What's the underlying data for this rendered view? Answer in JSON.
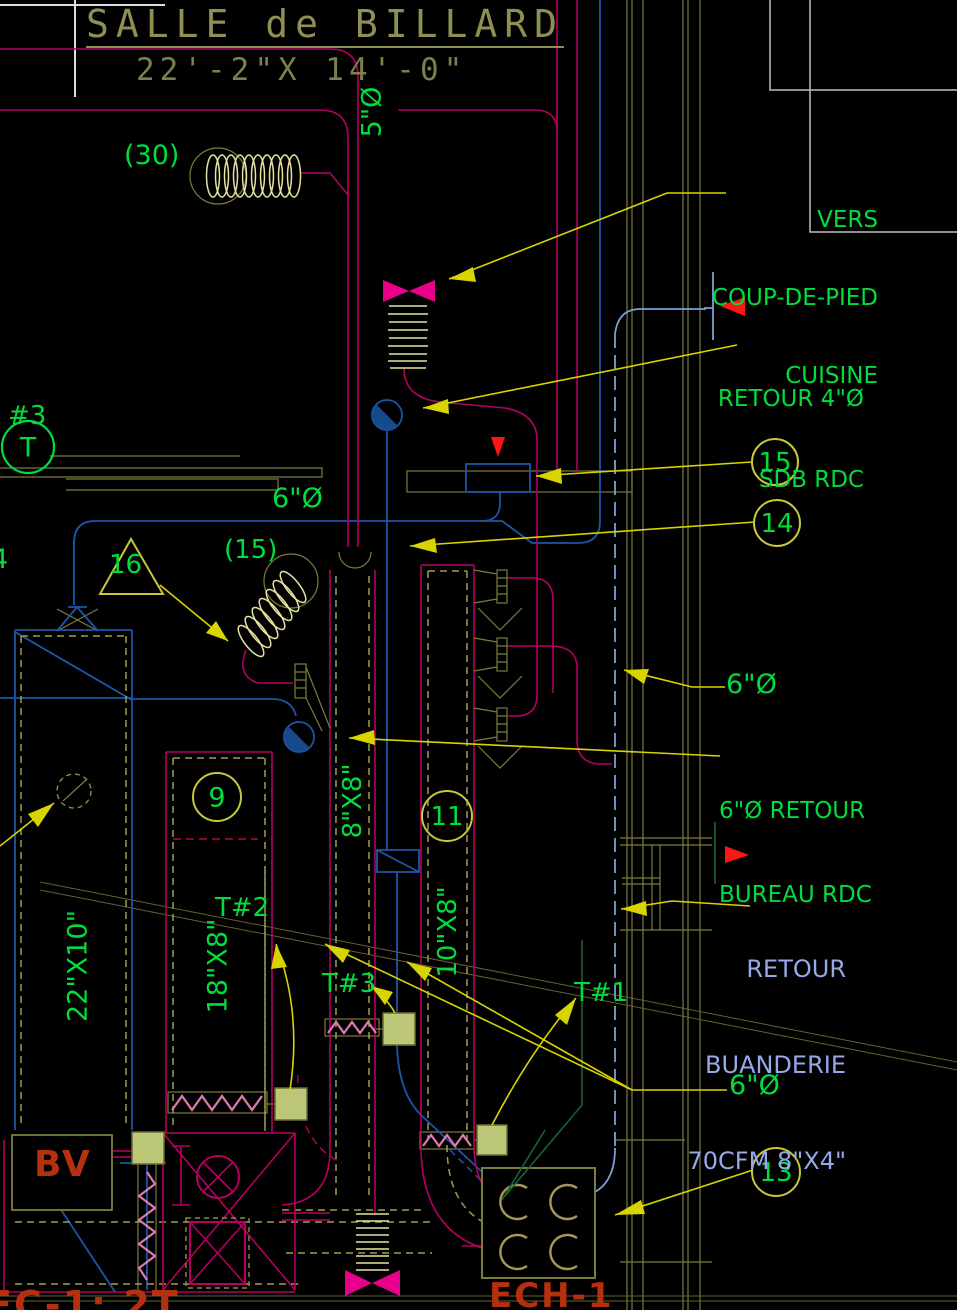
{
  "colors": {
    "background": "#000000",
    "annotation_green": "#00dd3c",
    "leader_yellow": "#d8d400",
    "supply_magenta": "#b5005f",
    "damper_pink": "#e8008c",
    "return_blue": "#1d56a8",
    "riser_light_blue": "#7aa0d4",
    "note_periwinkle": "#96a8e8",
    "equipment_red": "#b5300e",
    "structure_olive": "#7c7c3e",
    "flex_pale_yellow": "#e4e4a0",
    "flag_red": "#ff1515"
  },
  "symbols": {
    "bowtie": "balancing-damper",
    "accordion_coil": "flexible-duct",
    "half_filled_circle": "round-duct-drop",
    "ladder_rect": "sidewall-grille",
    "dashed_circle": "existing-opening",
    "c_coils": "heat-exchanger-coils",
    "red_triangle": "flow-direction-flag",
    "circle_number": "diffuser-callout",
    "triangle_number": "equipment-callout"
  },
  "room": {
    "title": "SALLE de BILLARD",
    "dimensions": "22'-2\"X 14'-0\""
  },
  "labels": {
    "riser5": "5\"Ø",
    "qty30": "(30)",
    "vers_line1": "VERS",
    "vers_line2": "COUP-DE-PIED",
    "vers_line3": "CUISINE",
    "retour4_line1": "RETOUR 4\"Ø",
    "retour4_line2": "SDB RDC",
    "dia6_left": "6\"Ø",
    "dia6_mid": "6\"Ø",
    "dia6_bottom": "6\"Ø",
    "note15": "(15)",
    "hash3": "#3",
    "t_letter": "T",
    "partial4": "4",
    "retour6_line1": "6\"Ø RETOUR",
    "retour6_line2": "BUREAU RDC",
    "buanderie_line1": "RETOUR",
    "buanderie_line2": "BUANDERIE",
    "buanderie_line3": "70CFM 8\"X4\"",
    "size22": "22\"X10\"",
    "size18": "18\"X8\"",
    "size8": "8\"X8\"",
    "size10": "10\"X8\"",
    "t1": "T#1",
    "t2": "T#2",
    "t3": "T#3",
    "bv": "BV",
    "ech": "ECH-1",
    "fc_partial": "FC-1: 2T"
  },
  "callouts": {
    "c9": "9",
    "c11": "11",
    "c13": "13",
    "c14": "14",
    "c15": "15",
    "c16": "16"
  }
}
